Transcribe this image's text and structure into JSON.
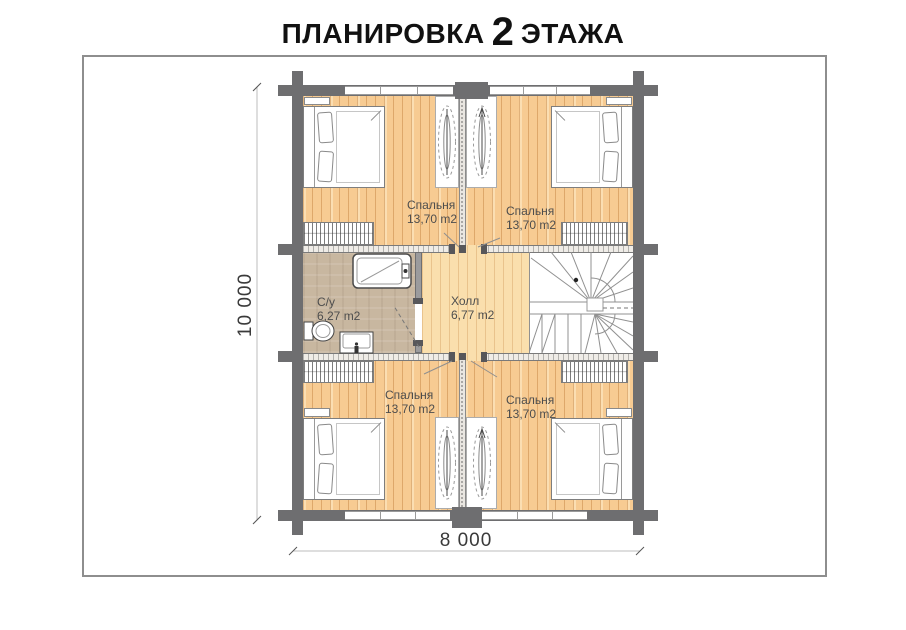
{
  "title": {
    "prefix": "ПЛАНИРОВКА",
    "number": "2",
    "suffix": "ЭТАЖА"
  },
  "plan": {
    "rooms": [
      {
        "id": "bedroom-top-left",
        "name": "Спальня",
        "area": "13,70 m2"
      },
      {
        "id": "bedroom-top-right",
        "name": "Спальня",
        "area": "13,70 m2"
      },
      {
        "id": "bathroom",
        "name": "С/у",
        "area": "6,27 m2"
      },
      {
        "id": "hall",
        "name": "Холл",
        "area": "6,77 m2"
      },
      {
        "id": "bedroom-bottom-left",
        "name": "Спальня",
        "area": "13,70 m2"
      },
      {
        "id": "bedroom-bottom-right",
        "name": "Спальня",
        "area": "13,70 m2"
      }
    ],
    "dimensions": {
      "width": "8 000",
      "height": "10 000"
    }
  },
  "colors": {
    "wall": "#6e6e70",
    "wood_floor": "#f7cb92",
    "hall_floor": "#fadfad",
    "bathroom_floor": "#c8b7a0",
    "panel_border": "#8e8e8e"
  }
}
